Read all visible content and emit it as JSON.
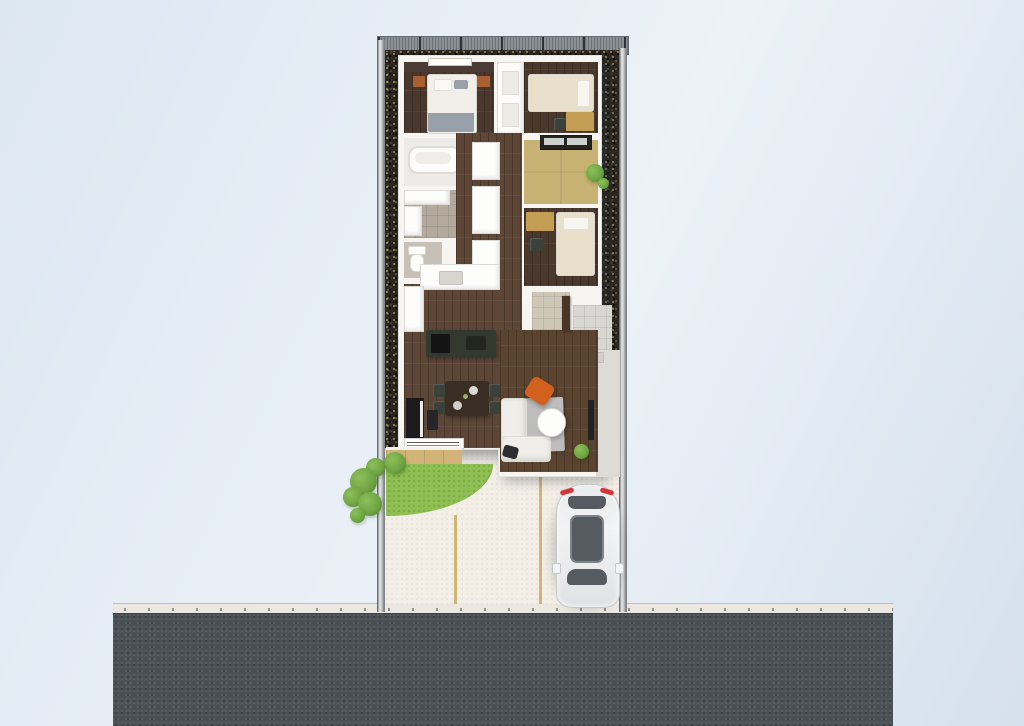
{
  "scene": {
    "type": "3d-floor-plan-render",
    "description": "Top-down 3D render of a narrow single-story house lot with side gravel strips, rear balcony railing, wood deck, quarter-circle lawn, tiled entrance walkway, driveway with parked white car, and street at the bottom",
    "palette": {
      "bg": "#dde7f2",
      "road": "#4a5156",
      "curb": "#ece7e0",
      "driveway": "#f3eee6",
      "marking": "#c9aa5f",
      "wall": "#b3b7ba",
      "gravel": "#2b261e",
      "railing": "#8a9298",
      "house": "#f6f5f2",
      "wood_dark": "#4a382c",
      "wood_mid": "#5d4636",
      "wood_warm": "#5a442f",
      "accent_wall": "#4a3c34",
      "tatami": "#c7b173",
      "bath_floor": "#edebe7",
      "tile_gray": "#b3a99c",
      "toilet_floor": "#c6c0b6",
      "tile_light": "#d8d7d2",
      "walkway": "#dcdbd6",
      "deck": "#d2b479",
      "grass": "#8fbf52",
      "bush": "#6da342",
      "plant": "#4e7c2a",
      "duvet": "#f1efe9",
      "blanket": "#98a1a9",
      "cream": "#e9e0cc",
      "nightstand": "#aa6132",
      "desk": "#c49e55",
      "counter": "#f5f4f1",
      "island": "#343930",
      "range": "#141414",
      "dining_table": "#3a2d24",
      "chair_dark": "#3a403a",
      "piano": "#1b1b1e",
      "rug": "#bdbdbd",
      "sofa": "#efeeea",
      "accent_chair": "#d2611d",
      "tv": "#1f2124",
      "cushion": "#2c2d30",
      "genkan_tile": "#cfc7b5",
      "door": "#4a3526",
      "car_body": "#f2f3f4",
      "car_glass": "#555b61",
      "taillight": "#d5383c",
      "white": "#fdfdfc"
    },
    "exterior": {
      "road": "asphalt street along the bottom",
      "curb": "light sidewalk strip with drainage dots",
      "driveway": "concrete driveway with two tan parking lines",
      "car": "white hatchback parked facing the street, dark glass roof, red taillights",
      "boundary": "low gray walls on left and right, mesh railing across the top",
      "garden": [
        "gravel strips along both sides",
        "wood deck off the dining room",
        "quarter-circle lawn",
        "shrubs along left boundary",
        "small plants in right gravel bed"
      ],
      "entrance": "tiled porch and walkway on the right side"
    },
    "house": {
      "rooms": [
        {
          "name": "master bedroom",
          "floor": "dark wood",
          "furniture": [
            "double bed with gray throw",
            "two orange-brown nightstands",
            "window"
          ]
        },
        {
          "name": "bedroom 2",
          "floor": "dark wood",
          "furniture": [
            "single bed",
            "desk",
            "chair"
          ]
        },
        {
          "name": "closet",
          "floor": "white",
          "furniture": [
            "shelves"
          ]
        },
        {
          "name": "bathroom",
          "floor": "white",
          "furniture": [
            "bathtub"
          ]
        },
        {
          "name": "washroom",
          "floor": "gray tile",
          "furniture": [
            "vanity",
            "washer"
          ]
        },
        {
          "name": "toilet",
          "floor": "gray tile",
          "furniture": [
            "toilet"
          ]
        },
        {
          "name": "tatami room",
          "floor": "tatami",
          "furniture": [
            "window"
          ]
        },
        {
          "name": "bedroom 3",
          "floor": "dark wood",
          "furniture": [
            "single bed",
            "desk",
            "chair"
          ]
        },
        {
          "name": "hallway",
          "floor": "dark wood",
          "furniture": [
            "storage closets"
          ]
        },
        {
          "name": "kitchen",
          "floor": "dark wood",
          "furniture": [
            "counter with sink",
            "dark island with cooktop"
          ]
        },
        {
          "name": "dining area",
          "floor": "dark wood",
          "furniture": [
            "dining table",
            "4 chairs",
            "upright piano",
            "piano bench"
          ]
        },
        {
          "name": "living room",
          "floor": "dark wood",
          "furniture": [
            "gray rug",
            "white corner sofa",
            "round coffee table",
            "orange accent chair",
            "wall tv",
            "potted plant",
            "floor cushion"
          ]
        },
        {
          "name": "entrance",
          "floor": "tile",
          "furniture": [
            "front door"
          ]
        }
      ]
    }
  }
}
